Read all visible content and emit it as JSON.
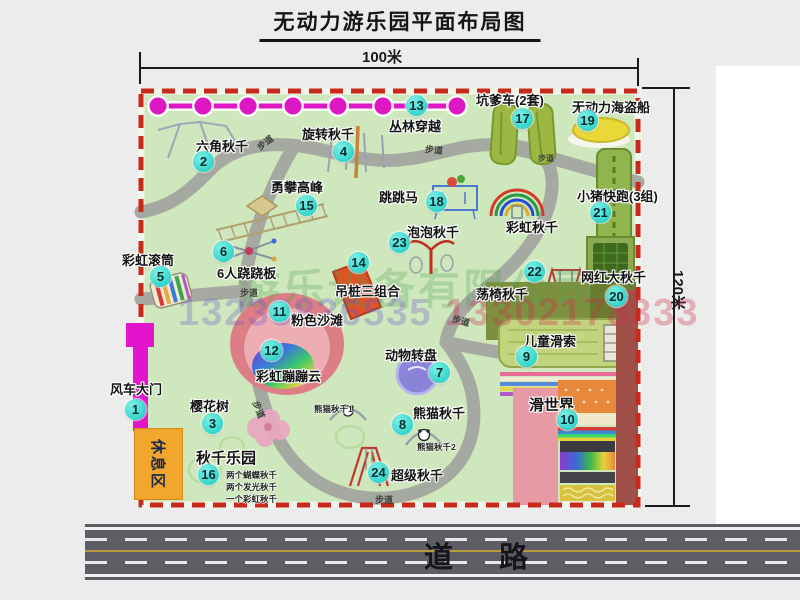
{
  "title": "无动力游乐园平面布局图",
  "dimensions": {
    "width": "100米",
    "height": "120米"
  },
  "road": {
    "label": "道路"
  },
  "trail": "步道",
  "rest_area": "休息区",
  "watermark": {
    "company": "游乐设备有限公司",
    "phone_left": "13233836535",
    "phone_right": "13302178333"
  },
  "colors": {
    "map_green": "#cee7bc",
    "border_red": "#c9291b",
    "badge_cyan": "#3ddbd2",
    "chain_magenta": "#dd17c4",
    "path_gray": "#a6a9a1",
    "road_gray": "#5d5d66",
    "rest_orange": "#f2a62c",
    "gate_magenta": "#e214cc"
  },
  "attractions": {
    "a1": {
      "num": "1",
      "label": "风车大门"
    },
    "a2": {
      "num": "2",
      "label": "六角秋千"
    },
    "a3": {
      "num": "3",
      "label": "樱花树"
    },
    "a4": {
      "num": "4",
      "label": "旋转秋千"
    },
    "a5": {
      "num": "5",
      "label": "彩虹滚筒"
    },
    "a6": {
      "num": "6",
      "label": "6人跷跷板"
    },
    "a7": {
      "num": "7",
      "label": "动物转盘"
    },
    "a8": {
      "num": "8",
      "label": "熊猫秋千"
    },
    "a9": {
      "num": "9",
      "label": "儿童滑索"
    },
    "a10": {
      "num": "10",
      "label": "滑世界"
    },
    "a11": {
      "num": "11",
      "label": "粉色沙滩"
    },
    "a12": {
      "num": "12",
      "label": "彩虹蹦蹦云"
    },
    "a13": {
      "num": "13",
      "label": "丛林穿越"
    },
    "a14": {
      "num": "14",
      "label": "吊桩三组合"
    },
    "a15": {
      "num": "15",
      "label": "勇攀高峰"
    },
    "a16": {
      "num": "16",
      "label": "秋千乐园",
      "notes": [
        "两个蝴蝶秋千",
        "两个发光秋千",
        "一个彩虹秋千"
      ]
    },
    "a17": {
      "num": "17",
      "label": "坑爹车(2套)"
    },
    "a18": {
      "num": "18",
      "label": "跳跳马"
    },
    "a19": {
      "num": "19",
      "label": "无动力海盗船"
    },
    "a20": {
      "num": "20",
      "label": "网红大秋千"
    },
    "a21": {
      "num": "21",
      "label": "小猪快跑(3组)"
    },
    "a22": {
      "num": "22",
      "label": "荡椅秋千"
    },
    "a23": {
      "num": "23",
      "label": "泡泡秋千"
    },
    "a24": {
      "num": "24",
      "label": "超级秋千"
    }
  },
  "unnumbered": {
    "rainbow_swing": "彩虹秋千",
    "panda_swing_1": "熊猫秋千1",
    "panda_swing_2": "熊猫秋千2"
  }
}
